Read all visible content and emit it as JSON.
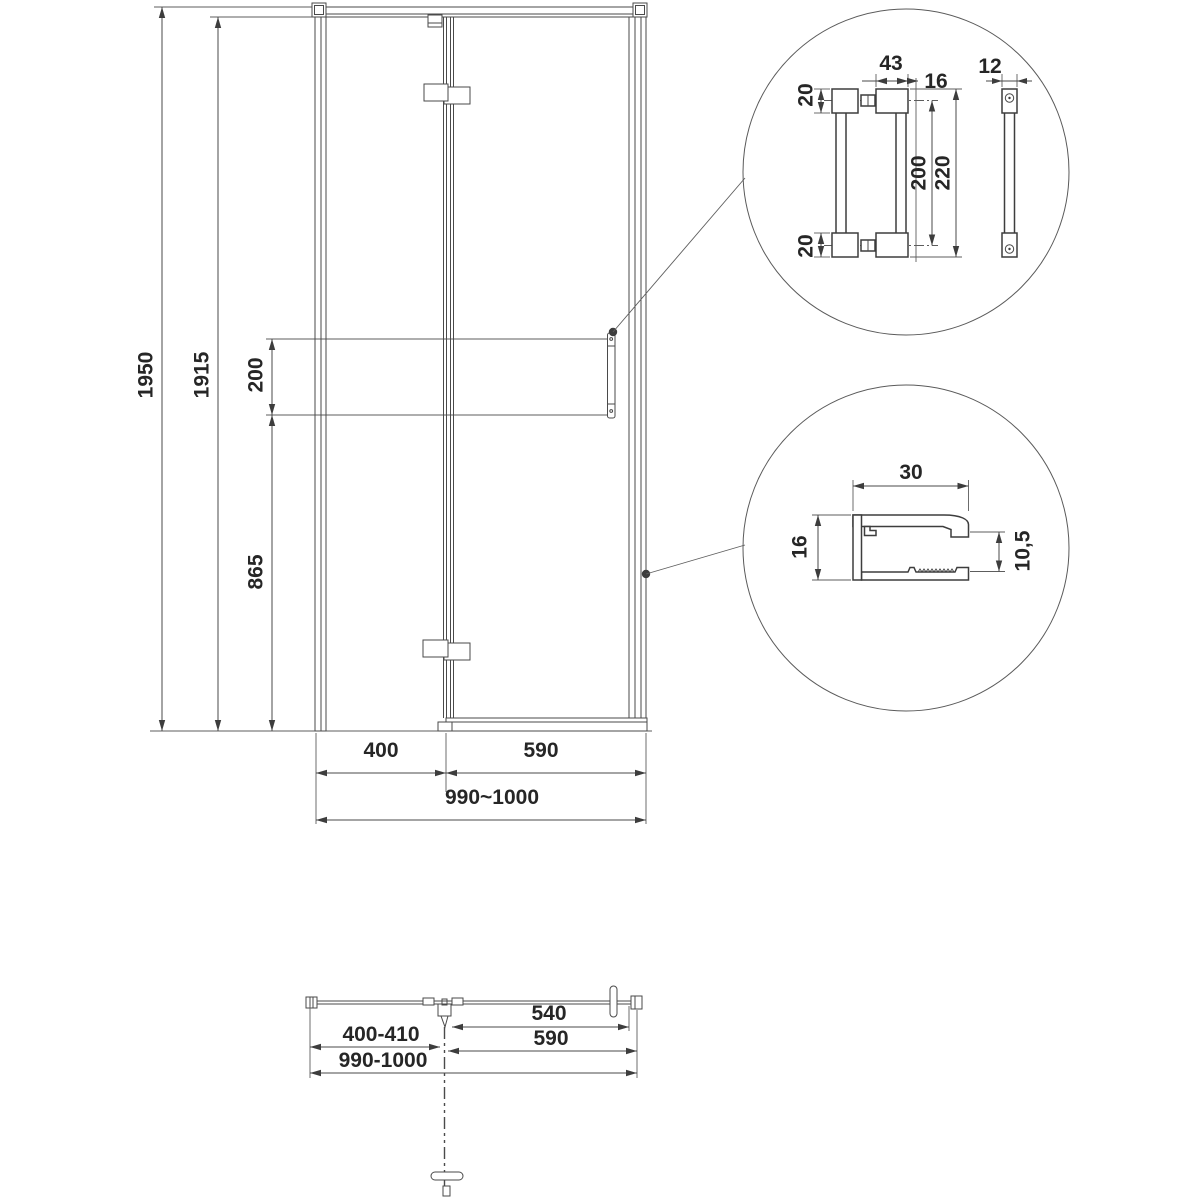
{
  "drawing_title": "shower-door-technical-drawing",
  "colors": {
    "line": "#3d3d3d",
    "dim_line": "#4a4a4a",
    "text": "#262626",
    "background": "#ffffff"
  },
  "front_view": {
    "height_total": "1950",
    "height_glass": "1915",
    "handle_length": "200",
    "handle_to_floor": "865",
    "width_fixed_panel": "400",
    "width_door": "590",
    "width_total": "990~1000"
  },
  "handle_detail": {
    "block_width": "43",
    "block_to_glass_edge": "16",
    "block_height_top": "20",
    "block_height_bottom": "20",
    "mount_spacing": "200",
    "total_length": "220",
    "bar_width": "12"
  },
  "profile_detail": {
    "width": "30",
    "height": "16",
    "inner_height": "10,5"
  },
  "top_view": {
    "door_glass_width": "540",
    "fixed_panel_range": "400-410",
    "door_width": "590",
    "width_total_range": "990-1000"
  }
}
